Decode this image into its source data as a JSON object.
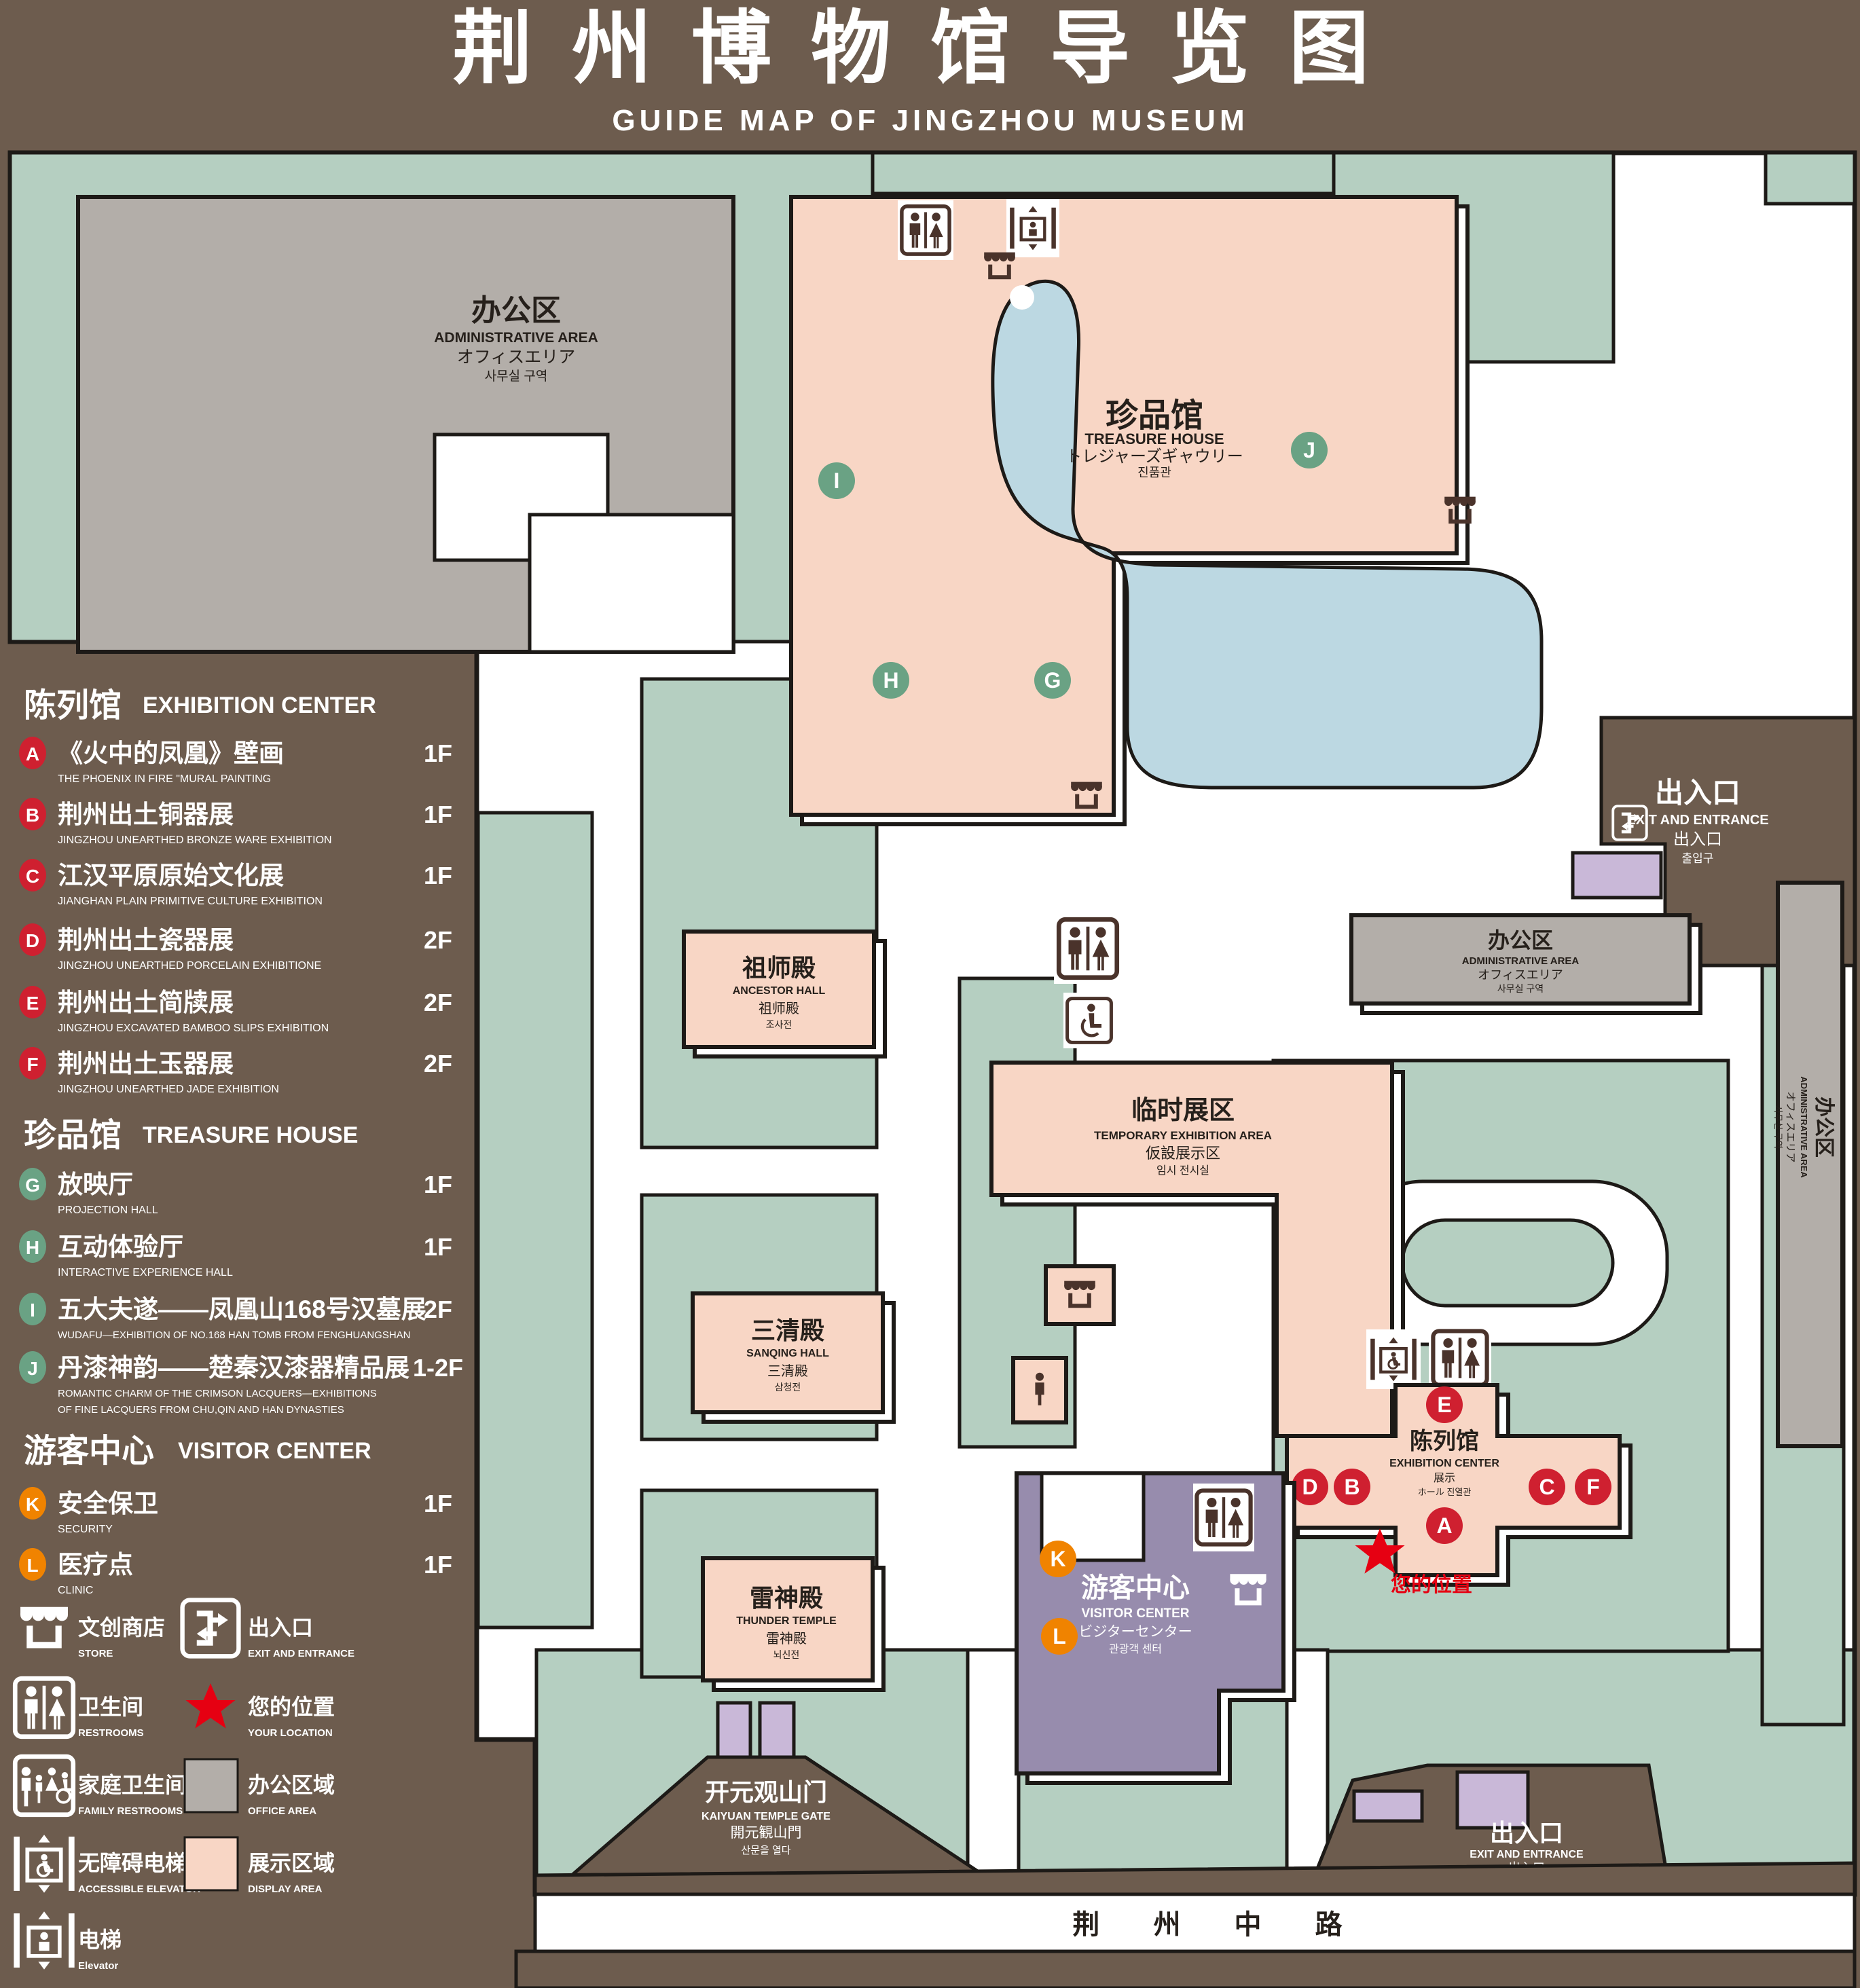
{
  "title": {
    "zh": "荆州博物馆导览图",
    "en": "GUIDE MAP OF JINGZHOU MUSEUM"
  },
  "colors": {
    "background": "#6d5c4e",
    "green_area": "#b5cfc1",
    "display_area": "#f8d6c5",
    "office_area": "#b3aea9",
    "visitor_center": "#978cad",
    "entrance_marker": "#c9b8d8",
    "pond": "#bcd8e2",
    "badge_red": "#cf2030",
    "badge_green": "#6aa284",
    "badge_orange": "#f08300",
    "location_red": "#e60012",
    "line": "#1d1a17"
  },
  "legend": {
    "sections": [
      {
        "zh": "陈列馆",
        "en": "EXHIBITION CENTER",
        "badge_color": "#cf2030",
        "items": [
          {
            "letter": "A",
            "zh": "《火中的凤凰》壁画",
            "en": "THE PHOENIX IN FIRE \"MURAL PAINTING",
            "floor": "1F"
          },
          {
            "letter": "B",
            "zh": "荆州出土铜器展",
            "en": "JINGZHOU UNEARTHED BRONZE WARE EXHIBITION",
            "floor": "1F"
          },
          {
            "letter": "C",
            "zh": "江汉平原原始文化展",
            "en": "JIANGHAN PLAIN PRIMITIVE CULTURE EXHIBITION",
            "floor": "1F"
          },
          {
            "letter": "D",
            "zh": "荆州出土瓷器展",
            "en": "JINGZHOU UNEARTHED PORCELAIN EXHIBITIONE",
            "floor": "2F"
          },
          {
            "letter": "E",
            "zh": "荆州出土简牍展",
            "en": "JINGZHOU EXCAVATED BAMBOO SLIPS EXHIBITION",
            "floor": "2F"
          },
          {
            "letter": "F",
            "zh": "荆州出土玉器展",
            "en": "JINGZHOU UNEARTHED JADE EXHIBITION",
            "floor": "2F"
          }
        ]
      },
      {
        "zh": "珍品馆",
        "en": "TREASURE HOUSE",
        "badge_color": "#6aa284",
        "items": [
          {
            "letter": "G",
            "zh": "放映厅",
            "en": "PROJECTION HALL",
            "floor": "1F"
          },
          {
            "letter": "H",
            "zh": "互动体验厅",
            "en": "INTERACTIVE EXPERIENCE HALL",
            "floor": "1F"
          },
          {
            "letter": "I",
            "zh": "五大夫遂——凤凰山168号汉墓展",
            "en": "WUDAFU—EXHIBITION OF NO.168 HAN TOMB FROM FENGHUANGSHAN",
            "floor": "2F"
          },
          {
            "letter": "J",
            "zh": "丹漆神韵——楚秦汉漆器精品展",
            "en": "ROMANTIC CHARM OF THE CRIMSON LACQUERS—EXHIBITIONS",
            "en2": "OF FINE LACQUERS FROM CHU,QIN AND HAN DYNASTIES",
            "floor": "1-2F"
          }
        ]
      },
      {
        "zh": "游客中心",
        "en": "VISITOR CENTER",
        "badge_color": "#f08300",
        "items": [
          {
            "letter": "K",
            "zh": "安全保卫",
            "en": "SECURITY",
            "floor": "1F"
          },
          {
            "letter": "L",
            "zh": "医疗点",
            "en": "CLINIC",
            "floor": "1F"
          }
        ]
      }
    ],
    "symbols": [
      {
        "icon": "store-icon",
        "zh": "文创商店",
        "en": "STORE"
      },
      {
        "icon": "exit-icon",
        "zh": "出入口",
        "en": "EXIT AND ENTRANCE"
      },
      {
        "icon": "restrooms-icon",
        "zh": "卫生间",
        "en": "RESTROOMS"
      },
      {
        "icon": "your-location-icon",
        "zh": "您的位置",
        "en": "YOUR LOCATION"
      },
      {
        "icon": "family-restrooms-icon",
        "zh": "家庭卫生间",
        "en": "FAMILY RESTROOMS"
      },
      {
        "icon": "office-area-swatch",
        "zh": "办公区域",
        "en": "OFFICE AREA"
      },
      {
        "icon": "accessible-elevator-icon",
        "zh": "无障碍电梯",
        "en": "ACCESSIBLE ELEVATOR"
      },
      {
        "icon": "display-area-swatch",
        "zh": "展示区域",
        "en": "DISPLAY AREA"
      },
      {
        "icon": "elevator-icon",
        "zh": "电梯",
        "en": "Elevator"
      }
    ]
  },
  "map": {
    "badges": {
      "a": "A",
      "b": "B",
      "c": "C",
      "d": "D",
      "e": "E",
      "f": "F",
      "g": "G",
      "h": "H",
      "i": "I",
      "j": "J",
      "k": "K",
      "l": "L"
    },
    "admin": {
      "zh": "办公区",
      "en": "ADMINISTRATIVE AREA",
      "ja": "オフィスエリア",
      "ko": "사무실 구역"
    },
    "treasure": {
      "zh": "珍品馆",
      "en": "TREASURE HOUSE",
      "ja": "トレジャーズギャウリー",
      "ko": "진품관"
    },
    "exit": {
      "zh": "出入口",
      "en": "EXIT AND ENTRANCE",
      "zh2": "出入口",
      "ko": "출입구"
    },
    "ancestor": {
      "zh": "祖师殿",
      "en": "ANCESTOR HALL",
      "ja": "祖师殿",
      "ko": "조사전"
    },
    "temporary": {
      "zh": "临时展区",
      "en": "TEMPORARY EXHIBITION AREA",
      "ja": "仮設展示区",
      "ko": "임시 전시실"
    },
    "sanqing": {
      "zh": "三清殿",
      "en": "SANQING HALL",
      "ja": "三清殿",
      "ko": "삼청전"
    },
    "thunder": {
      "zh": "雷神殿",
      "en": "THUNDER TEMPLE",
      "ja": "雷神殿",
      "ko": "뇌신전"
    },
    "exhibition": {
      "zh": "陈列馆",
      "en": "EXHIBITION CENTER",
      "l3": "展示",
      "l4": "ホール 진열관"
    },
    "visitor": {
      "zh": "游客中心",
      "en": "VISITOR CENTER",
      "ja": "ビジターセンター",
      "ko": "관광객 센터"
    },
    "gate": {
      "zh": "开元观山门",
      "en": "KAIYUAN TEMPLE GATE",
      "ja": "開元観山門",
      "ko": "산문을 열다"
    },
    "road": "荆 州 中 路",
    "your_location": "您的位置"
  }
}
